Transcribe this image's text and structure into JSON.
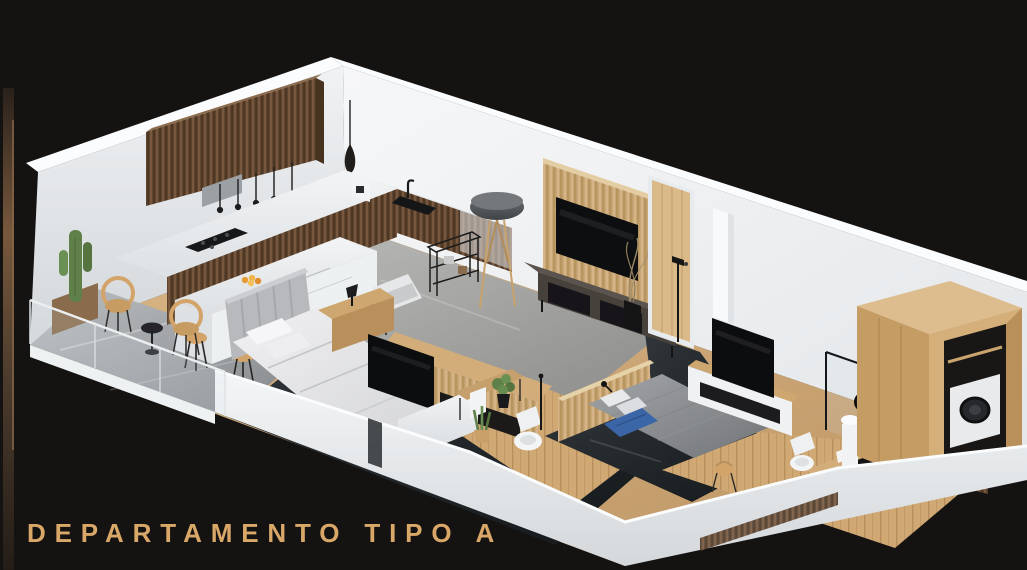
{
  "title": {
    "text": "DEPARTAMENTO TIPO A"
  },
  "palette": {
    "background": "#151212",
    "title_gold": "#d9a768",
    "wall_bright": "#f5f6f7",
    "wall_mid": "#e7eaec",
    "wall_shadow": "#cfd3d6",
    "wood_light": "#d7b584",
    "wood_mid": "#c59f6c",
    "walnut_dark": "#5f4430",
    "oak_slat": "#c9a878",
    "floor_wood": "#cfa873",
    "floor_dark": "#22272a",
    "marble_gray": "#a7abae",
    "marble_light": "#eef0f1",
    "textile_light": "#e8e9eb",
    "textile_gray": "#939699",
    "accent_blue": "#3a66a8",
    "plant_green": "#5f8049",
    "rattan": "#d3a469",
    "strip_brown_light": "#77583c",
    "strip_brown_dark": "#2b211a"
  },
  "scene": {
    "type": "isometric-3d-apartment-render",
    "rooms": [
      "balcony",
      "kitchen",
      "living-room",
      "bedroom-1",
      "bathroom-1",
      "bedroom-2",
      "hallway",
      "desk-nook",
      "bathroom-2",
      "laundry-closet"
    ],
    "furniture": [
      "upper-cabinets",
      "cooktop",
      "sink",
      "kitchen-island",
      "fruit-bowl",
      "bar-stool",
      "rattan-chair",
      "cactus-planter",
      "side-table",
      "floor-lamp",
      "pendant-lamp",
      "metal-shelf",
      "tv-slat-wall",
      "tv",
      "media-console",
      "entry-door",
      "bed-white",
      "bed-gray",
      "headboard",
      "nightstand",
      "tv-cabinet",
      "toilet",
      "vanity",
      "towel",
      "potted-plant",
      "glass-shower",
      "pedestal-sink",
      "round-mirror",
      "desk",
      "desk-chair",
      "wardrobe",
      "washing-machine",
      "glass-railing"
    ]
  }
}
